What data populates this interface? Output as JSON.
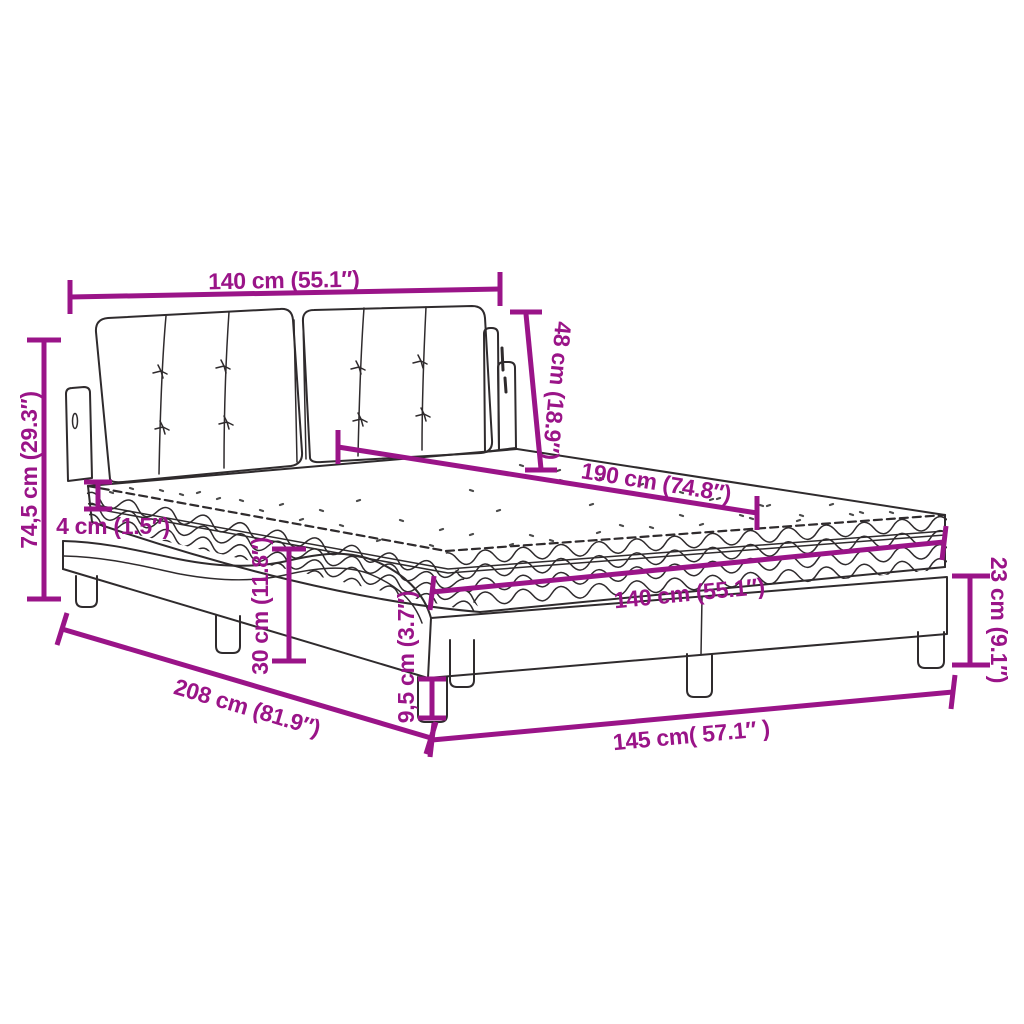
{
  "title": "Bed with mattress dimension diagram",
  "accent_color": "#9A1488",
  "outline_color": "#2F2B2D",
  "background_color": "#ffffff",
  "dimensions": [
    {
      "name": "headboard-width",
      "label": "140 cm (55.1″)"
    },
    {
      "name": "headboard-height",
      "label": "48 cm (18.9″)"
    },
    {
      "name": "bed-length",
      "label": "190 cm (74.8″)"
    },
    {
      "name": "overall-height",
      "label": "74,5 cm (29.3″)"
    },
    {
      "name": "mattress-edge-thickness",
      "label": "4 cm (1.5″)"
    },
    {
      "name": "frame-mid-height",
      "label": "30 cm (11.8″)"
    },
    {
      "name": "leg-height",
      "label": "9,5 cm (3.7″)"
    },
    {
      "name": "base-height",
      "label": "23 cm (9.1″)"
    },
    {
      "name": "overall-length",
      "label": "208 cm (81.9″)"
    },
    {
      "name": "base-length",
      "label": "145 cm( 57.1″ )"
    },
    {
      "name": "mattress-width",
      "label": "140 cm (55.1″)"
    }
  ]
}
